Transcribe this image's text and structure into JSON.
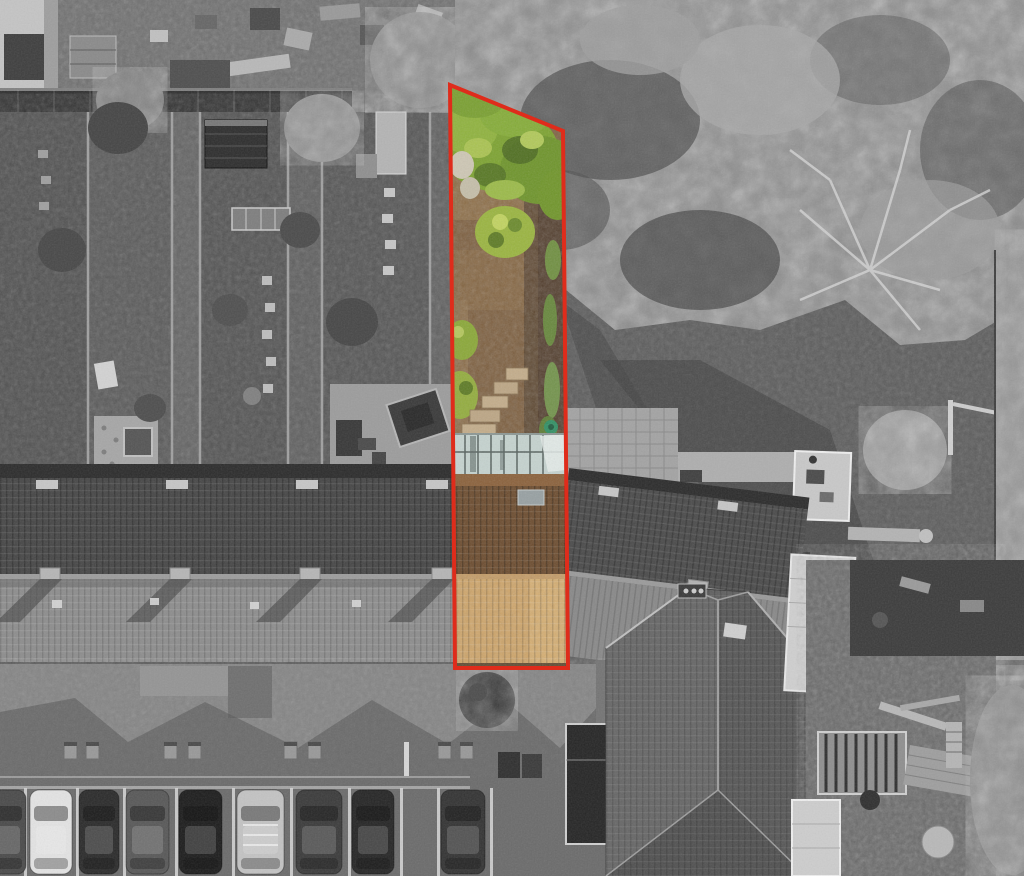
{
  "meta": {
    "type": "aerial-drone-photograph",
    "style": "black-and-white aerial photo with one plot highlighted in full colour and outlined in red",
    "width_px": 1024,
    "height_px": 876
  },
  "plot_highlight": {
    "boundary_points": "450,85 563,131 568,668 455,668",
    "outline_color": "#df2c1b",
    "outline_width": 4,
    "interior": "full colour (greens, browns, orange roof tiles) against greyscale surroundings",
    "contents": [
      "tree canopy",
      "green shrubs",
      "bare earth rear garden",
      "stepped paving",
      "conservatory glass roof",
      "section of terraced roof",
      "rear parking strip"
    ]
  },
  "surroundings": {
    "top_left": "cluttered rear yards and a corrugated boundary wall",
    "left": "parallel terraced rear gardens with sheds, patios and hot tubs",
    "right": "dense mature tree canopy over a large lawn with a small white greenhouse",
    "bottom": "long terraced roof, paved service lane and a row of parked cars",
    "bottom_right": "hip-roofed end house beside a junk-filled yard"
  },
  "palette": {
    "mono_base": "#777777",
    "mono_dark": "#2f2f2f",
    "mono_mid": "#6e6e6e",
    "mono_light": "#9a9a9a",
    "mono_white": "#d9d9d9",
    "canopy_green": "#7ca32e",
    "canopy_green_light": "#aac44f",
    "canopy_green_dark": "#4c6b1e",
    "bush_green": "#9ab53d",
    "soil_brown": "#7a5a38",
    "soil_brown_dark": "#57402a",
    "soil_brown_light": "#8d6b42",
    "roof_tile_brown": "#6b4a2c",
    "roof_tile_tan": "#d0a465",
    "conservatory_glass": "#c6d4d0",
    "grass_path_green": "#6f8f3f",
    "watering_can_teal": "#2f8f63"
  },
  "roof": {
    "chimney_xs": [
      40,
      170,
      300,
      432
    ],
    "vent_xs": [
      36,
      166,
      296,
      426
    ]
  },
  "lane": {
    "bollard_xs": [
      64,
      86,
      164,
      188,
      284,
      308,
      438,
      460
    ]
  },
  "parking": {
    "line_xs": [
      24,
      76,
      123,
      175,
      232,
      290,
      348,
      400,
      437,
      490
    ],
    "cars": [
      {
        "x": -16,
        "w": 42,
        "color": "#4a4a4a",
        "kind": "car"
      },
      {
        "x": 30,
        "w": 42,
        "color": "#e3e3e3",
        "kind": "car"
      },
      {
        "x": 79,
        "w": 40,
        "color": "#2b2b2b",
        "kind": "car"
      },
      {
        "x": 126,
        "w": 43,
        "color": "#585858",
        "kind": "car"
      },
      {
        "x": 179,
        "w": 43,
        "color": "#1d1d1d",
        "kind": "car"
      },
      {
        "x": 237,
        "w": 47,
        "color": "#c3c3c3",
        "kind": "van"
      },
      {
        "x": 296,
        "w": 46,
        "color": "#3b3b3b",
        "kind": "suv"
      },
      {
        "x": 352,
        "w": 42,
        "color": "#262626",
        "kind": "car"
      },
      {
        "x": 441,
        "w": 44,
        "color": "#343434",
        "kind": "car"
      }
    ]
  }
}
